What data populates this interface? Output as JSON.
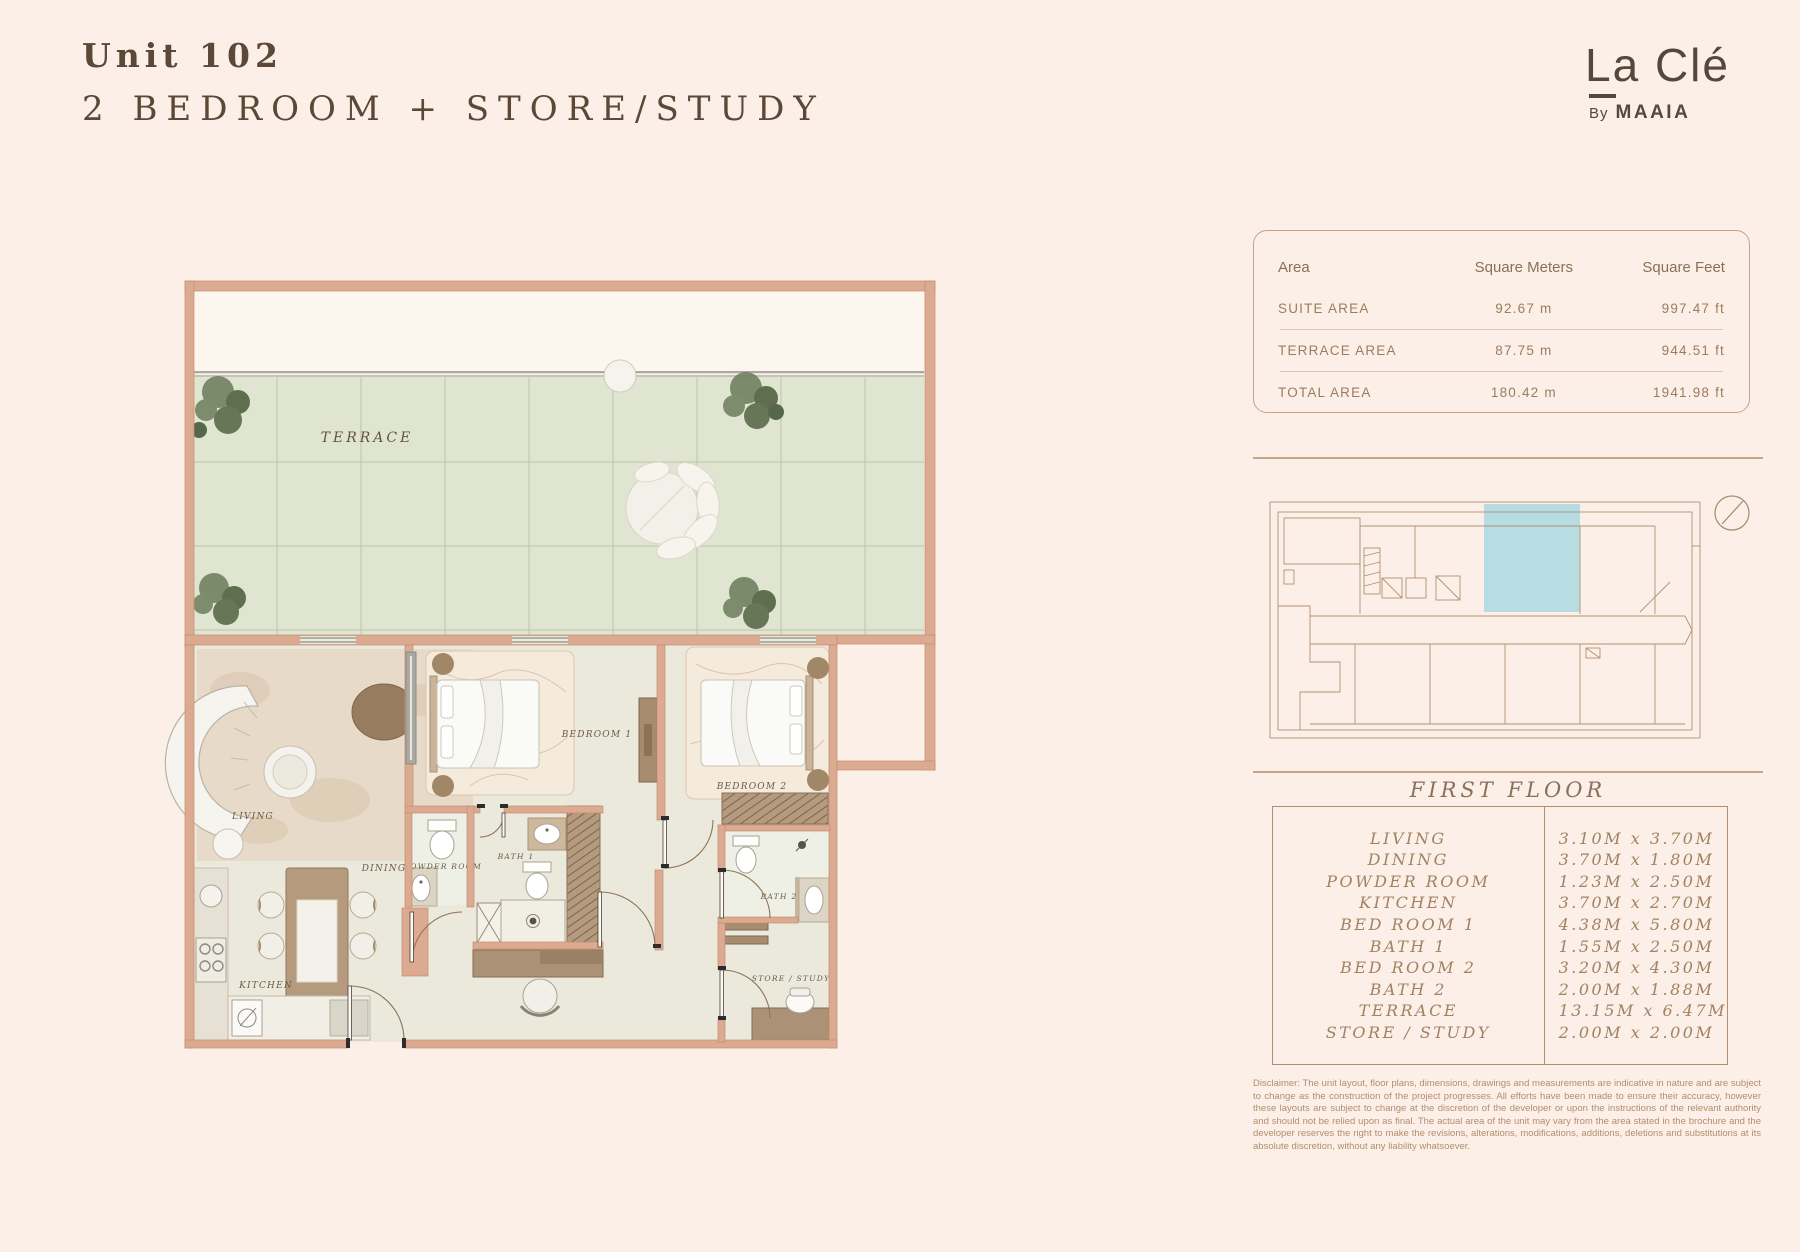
{
  "header": {
    "title_line1": "Unit 102",
    "title_line2": "2 BEDROOM + STORE/STUDY"
  },
  "logo": {
    "brand": "La Clé",
    "by": "By",
    "name": "MAAIA"
  },
  "area_table": {
    "headers": [
      "Area",
      "Square Meters",
      "Square Feet"
    ],
    "rows": [
      {
        "label": "SUITE AREA",
        "sqm": "92.67 m",
        "sqft": "997.47 ft"
      },
      {
        "label": "TERRACE AREA",
        "sqm": "87.75 m",
        "sqft": "944.51 ft"
      },
      {
        "label": "TOTAL AREA",
        "sqm": "180.42 m",
        "sqft": "1941.98 ft"
      }
    ]
  },
  "key_plan": {
    "highlight_color": "#b7dce2"
  },
  "floor_section": {
    "heading": "FIRST FLOOR",
    "rooms": [
      {
        "name": "LIVING",
        "dim": "3.10M x 3.70M"
      },
      {
        "name": "DINING",
        "dim": "3.70M x 1.80M"
      },
      {
        "name": "POWDER ROOM",
        "dim": "1.23M x 2.50M"
      },
      {
        "name": "KITCHEN",
        "dim": "3.70M x 2.70M"
      },
      {
        "name": "BED ROOM 1",
        "dim": "4.38M x 5.80M"
      },
      {
        "name": "BATH 1",
        "dim": "1.55M x 2.50M"
      },
      {
        "name": "BED ROOM 2",
        "dim": "3.20M x 4.30M"
      },
      {
        "name": "BATH 2",
        "dim": "2.00M x 1.88M"
      },
      {
        "name": "TERRACE",
        "dim": "13.15M x 6.47M"
      },
      {
        "name": "STORE / STUDY",
        "dim": "2.00M x 2.00M"
      }
    ]
  },
  "plan_labels": {
    "terrace": "TERRACE",
    "living": "LIVING",
    "dining": "DINING",
    "kitchen": "KITCHEN",
    "powder": "POWDER ROOM",
    "bath1": "BATH 1",
    "bath2": "BATH 2",
    "bedroom1": "BEDROOM 1",
    "bedroom2": "BEDROOM 2",
    "store": "STORE / STUDY"
  },
  "disclaimer": "Disclaimer: The unit layout, floor plans, dimensions, drawings and measurements are indicative in nature and are subject to change as the construction of the project progresses. All efforts have been made to ensure their accuracy, however these layouts are subject to change at the discretion of the developer or upon the instructions of the relevant authority and should not be relied upon as final. The actual area of the unit may vary from the area stated in the brochure and the developer reserves the right to make the revisions, alterations, modifications, additions, deletions and substitutions at its absolute discretion, without any liability whatsoever."
}
